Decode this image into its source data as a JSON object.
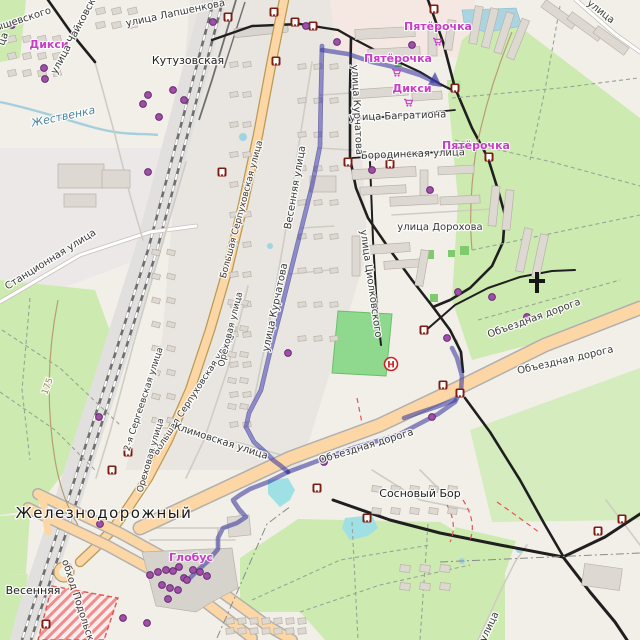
{
  "map": {
    "description": "OpenStreetMap-style city map with public-transport route overlay",
    "colors": {
      "background": "#f2efe9",
      "forest": "#cdeab0",
      "pitch": "#8fd98f",
      "primary_road": "#fcd6a4",
      "route_overlay": "#3a38a0",
      "shop_label": "#c73ec7",
      "water": "#a6cfdd",
      "transit_icon": "#7d1d12",
      "poi_dot": "#a04fa8",
      "hospital_red": "#cc2222",
      "construction": "#e05555"
    }
  },
  "hospital": {
    "letter": "Н"
  },
  "labels": [
    {
      "text": "ышевского",
      "x": 24,
      "y": 22,
      "r": -18,
      "c": "st"
    },
    {
      "text": "ца",
      "x": 6,
      "y": 40,
      "r": -70,
      "c": "st"
    },
    {
      "text": "Дикси",
      "x": 49,
      "y": 48,
      "r": 0,
      "c": "shop"
    },
    {
      "text": "улица Чайковского",
      "x": 80,
      "y": 30,
      "r": -62,
      "c": "st"
    },
    {
      "text": "улица Лапшенкова",
      "x": 176,
      "y": 16,
      "r": -12,
      "c": "st"
    },
    {
      "text": "Кутузовская",
      "x": 188,
      "y": 64,
      "r": 0,
      "c": "place"
    },
    {
      "text": "Жественка",
      "x": 64,
      "y": 120,
      "r": -12,
      "c": "water"
    },
    {
      "text": "Пятёрочка",
      "x": 438,
      "y": 30,
      "r": 0,
      "c": "shop"
    },
    {
      "text": "Пятёрочка",
      "x": 398,
      "y": 62,
      "r": 0,
      "c": "shop"
    },
    {
      "text": "Дикси",
      "x": 412,
      "y": 92,
      "r": 0,
      "c": "shop"
    },
    {
      "text": "улица Багратиона",
      "x": 398,
      "y": 119,
      "r": -2,
      "c": "st"
    },
    {
      "text": "Бородинская улица",
      "x": 413,
      "y": 157,
      "r": -2,
      "c": "st"
    },
    {
      "text": "Пятёрочка",
      "x": 476,
      "y": 149,
      "r": 0,
      "c": "shop"
    },
    {
      "text": "улица",
      "x": 599,
      "y": 14,
      "r": 38,
      "c": "st"
    },
    {
      "text": "улица Дорохова",
      "x": 440,
      "y": 230,
      "r": 0,
      "c": "st"
    },
    {
      "text": "улица Циолковского",
      "x": 368,
      "y": 284,
      "r": 82,
      "c": "st"
    },
    {
      "text": "улица Курчатова",
      "x": 354,
      "y": 110,
      "r": 87,
      "c": "st"
    },
    {
      "text": "улица Курчатова",
      "x": 278,
      "y": 308,
      "r": -78,
      "c": "st"
    },
    {
      "text": "Весенняя улица",
      "x": 298,
      "y": 188,
      "r": -80,
      "c": "st"
    },
    {
      "text": "Большая Серпуховская улица",
      "x": 244,
      "y": 210,
      "r": -75,
      "c": "sts"
    },
    {
      "text": "Большая Серпуховская улица",
      "x": 196,
      "y": 396,
      "r": -57,
      "c": "sts"
    },
    {
      "text": "2-я Сергеевская улица",
      "x": 146,
      "y": 400,
      "r": -72,
      "c": "sts"
    },
    {
      "text": "Станционная улица",
      "x": 52,
      "y": 262,
      "r": -32,
      "c": "st"
    },
    {
      "text": "Ореховая улица",
      "x": 233,
      "y": 330,
      "r": -76,
      "c": "sts"
    },
    {
      "text": "Ореховая улица",
      "x": 153,
      "y": 456,
      "r": -74,
      "c": "sts"
    },
    {
      "text": "Климовская улица",
      "x": 220,
      "y": 444,
      "r": 18,
      "c": "st"
    },
    {
      "text": "Железнодорожный",
      "x": 104,
      "y": 518,
      "r": 0,
      "c": "city"
    },
    {
      "text": "Весенняя",
      "x": 33,
      "y": 594,
      "r": 0,
      "c": "place"
    },
    {
      "text": "обход Подольска",
      "x": 76,
      "y": 604,
      "r": 72,
      "c": "st"
    },
    {
      "text": "Глобус",
      "x": 191,
      "y": 561,
      "r": 0,
      "c": "shop"
    },
    {
      "text": "Сосновый Бор",
      "x": 420,
      "y": 497,
      "r": 0,
      "c": "place"
    },
    {
      "text": "Объездная дорога",
      "x": 367,
      "y": 449,
      "r": -17,
      "c": "st"
    },
    {
      "text": "Объездная дорога",
      "x": 535,
      "y": 321,
      "r": -20,
      "c": "st"
    },
    {
      "text": "Объездная дорога",
      "x": 566,
      "y": 363,
      "r": -13,
      "c": "st"
    },
    {
      "text": "улица",
      "x": 492,
      "y": 628,
      "r": -65,
      "c": "st"
    },
    {
      "text": "175",
      "x": 50,
      "y": 387,
      "r": -70,
      "c": "path"
    }
  ],
  "transit_stops": [
    [
      228,
      17
    ],
    [
      274,
      12
    ],
    [
      295,
      22
    ],
    [
      313,
      26
    ],
    [
      276,
      61
    ],
    [
      434,
      9
    ],
    [
      222,
      172
    ],
    [
      348,
      162
    ],
    [
      390,
      164
    ],
    [
      455,
      88
    ],
    [
      489,
      157
    ],
    [
      424,
      330
    ],
    [
      443,
      385
    ],
    [
      460,
      393
    ],
    [
      317,
      488
    ],
    [
      367,
      518
    ],
    [
      128,
      452
    ],
    [
      112,
      470
    ],
    [
      46,
      624
    ],
    [
      598,
      531
    ],
    [
      622,
      519
    ]
  ],
  "poi_dots": [
    [
      12,
      25
    ],
    [
      44,
      68
    ],
    [
      45,
      79
    ],
    [
      148,
      95
    ],
    [
      143,
      104
    ],
    [
      173,
      90
    ],
    [
      184,
      100
    ],
    [
      159,
      117
    ],
    [
      213,
      22
    ],
    [
      306,
      26
    ],
    [
      337,
      42
    ],
    [
      412,
      45
    ],
    [
      372,
      170
    ],
    [
      430,
      190
    ],
    [
      288,
      353
    ],
    [
      148,
      172
    ],
    [
      99,
      417
    ],
    [
      458,
      292
    ],
    [
      492,
      297
    ],
    [
      447,
      338
    ],
    [
      527,
      317
    ],
    [
      432,
      417
    ],
    [
      324,
      462
    ],
    [
      100,
      524
    ],
    [
      150,
      575
    ],
    [
      158,
      572
    ],
    [
      166,
      570
    ],
    [
      173,
      571
    ],
    [
      179,
      567
    ],
    [
      184,
      578
    ],
    [
      162,
      585
    ],
    [
      170,
      588
    ],
    [
      178,
      590
    ],
    [
      193,
      570
    ],
    [
      187,
      580
    ],
    [
      168,
      599
    ],
    [
      200,
      572
    ],
    [
      207,
      576
    ],
    [
      123,
      618
    ],
    [
      147,
      623
    ]
  ],
  "shop_carts": [
    [
      437,
      42
    ],
    [
      396,
      73
    ],
    [
      408,
      103
    ]
  ]
}
